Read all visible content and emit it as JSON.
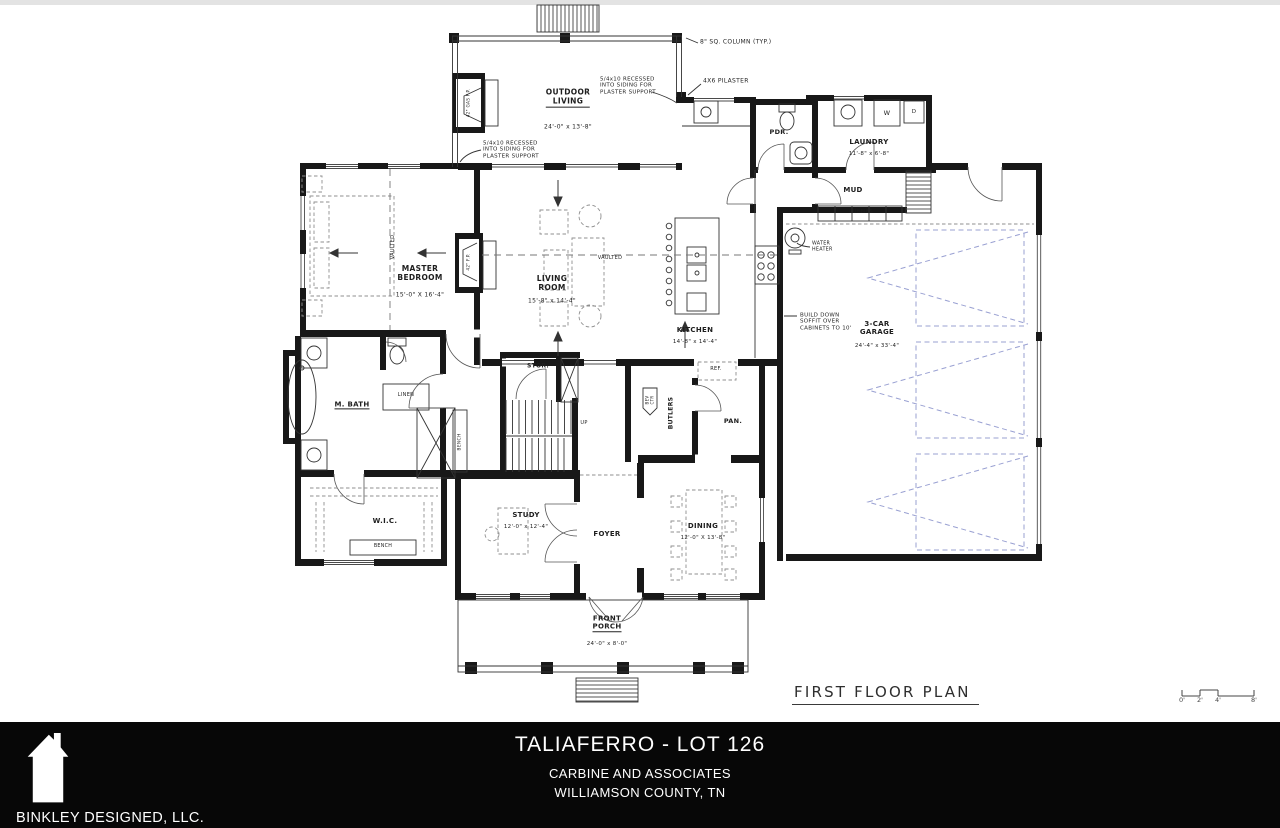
{
  "drawing": {
    "caption": "FIRST FLOOR PLAN",
    "scale_bar": {
      "tick_labels": [
        "0'",
        "2'",
        "4'",
        "8'"
      ]
    }
  },
  "plan": {
    "ink": "#181818",
    "furniture_color": "#8f8f8f",
    "garage_dash_color": "#99a0d2",
    "labels": [
      {
        "n": "room-outdoor-living",
        "t": [
          "OUTDOOR",
          "LIVING"
        ],
        "x": 568,
        "y": 98,
        "fs": 7.5,
        "b": 1,
        "ul": 1
      },
      {
        "n": "dim-outdoor-living",
        "t": [
          "24'-0\" x 13'-8\""
        ],
        "x": 568,
        "y": 127,
        "fs": 6
      },
      {
        "n": "ann-sq-column",
        "t": [
          "8\" SQ. COLUMN (TYP.)"
        ],
        "x": 700,
        "y": 42,
        "fs": 6,
        "al": "left"
      },
      {
        "n": "ann-pilaster",
        "t": [
          "4X6 PILASTER"
        ],
        "x": 703,
        "y": 81,
        "fs": 6,
        "al": "left"
      },
      {
        "n": "ann-recessed-right",
        "t": [
          "5/4x10 RECESSED",
          "INTO SIDING FOR",
          "PLASTER SUPPORT"
        ],
        "x": 600,
        "y": 86,
        "fs": 5.5,
        "al": "left"
      },
      {
        "n": "ann-recessed-left",
        "t": [
          "5/4x10 RECESSED",
          "INTO SIDING FOR",
          "PLASTER SUPPORT"
        ],
        "x": 483,
        "y": 150,
        "fs": 5.5,
        "al": "left"
      },
      {
        "n": "lbl-gas-fireplace",
        "t": [
          "42\" GAS F.P."
        ],
        "x": 469,
        "y": 103,
        "fs": 4.2,
        "r": -90
      },
      {
        "n": "room-powder",
        "t": [
          "PDR."
        ],
        "x": 779,
        "y": 133,
        "fs": 6.5,
        "b": 1
      },
      {
        "n": "room-laundry",
        "t": [
          "LAUNDRY"
        ],
        "x": 869,
        "y": 142,
        "fs": 7,
        "b": 1
      },
      {
        "n": "dim-laundry",
        "t": [
          "11'-8\" x 6'-8\""
        ],
        "x": 869,
        "y": 154,
        "fs": 5.5
      },
      {
        "n": "room-mud",
        "t": [
          "MUD"
        ],
        "x": 853,
        "y": 190,
        "fs": 7,
        "b": 1
      },
      {
        "n": "lbl-cubbies",
        "t": [
          "CUBBIES"
        ],
        "x": 861,
        "y": 213,
        "fs": 5
      },
      {
        "n": "lbl-washer",
        "t": [
          "W"
        ],
        "x": 887,
        "y": 114,
        "fs": 6.5
      },
      {
        "n": "lbl-dryer",
        "t": [
          "D"
        ],
        "x": 914,
        "y": 112,
        "fs": 5.5
      },
      {
        "n": "room-master-bedroom",
        "t": [
          "MASTER",
          "BEDROOM"
        ],
        "x": 420,
        "y": 274,
        "fs": 7.5,
        "b": 1
      },
      {
        "n": "dim-master-bedroom",
        "t": [
          "15'-0\" X 16'-4\""
        ],
        "x": 420,
        "y": 295,
        "fs": 6
      },
      {
        "n": "lbl-vaulted-master",
        "t": [
          "VAULTED"
        ],
        "x": 394,
        "y": 247,
        "fs": 5,
        "r": -90
      },
      {
        "n": "lbl-fireplace",
        "t": [
          "42\" F.P."
        ],
        "x": 469,
        "y": 262,
        "fs": 4.2,
        "r": -90
      },
      {
        "n": "room-living",
        "t": [
          "LIVING",
          "ROOM"
        ],
        "x": 552,
        "y": 284,
        "fs": 7.5,
        "b": 1
      },
      {
        "n": "dim-living",
        "t": [
          "15'-8\" x 14'-4\""
        ],
        "x": 552,
        "y": 301,
        "fs": 6
      },
      {
        "n": "lbl-vaulted-living",
        "t": [
          "VAULTED"
        ],
        "x": 610,
        "y": 259,
        "fs": 5
      },
      {
        "n": "room-kitchen",
        "t": [
          "KITCHEN"
        ],
        "x": 695,
        "y": 330,
        "fs": 7,
        "b": 1
      },
      {
        "n": "dim-kitchen",
        "t": [
          "14'-8\" x 14'-4\""
        ],
        "x": 695,
        "y": 342,
        "fs": 5.5
      },
      {
        "n": "ann-water-heater",
        "t": [
          "WATER",
          "HEATER"
        ],
        "x": 812,
        "y": 247,
        "fs": 4.8,
        "al": "left"
      },
      {
        "n": "ann-soffit",
        "t": [
          "BUILD DOWN",
          "SOFFIT OVER",
          "CABINETS TO 10'"
        ],
        "x": 800,
        "y": 322,
        "fs": 5.5,
        "al": "left"
      },
      {
        "n": "room-garage",
        "t": [
          "3-CAR",
          "GARAGE"
        ],
        "x": 877,
        "y": 328,
        "fs": 7,
        "b": 1
      },
      {
        "n": "dim-garage",
        "t": [
          "24'-4\" x 33'-4\""
        ],
        "x": 877,
        "y": 346,
        "fs": 5.5
      },
      {
        "n": "room-storage",
        "t": [
          "STOR."
        ],
        "x": 538,
        "y": 366,
        "fs": 6,
        "b": 1
      },
      {
        "n": "lbl-stairs-up",
        "t": [
          "UP"
        ],
        "x": 584,
        "y": 424,
        "fs": 5
      },
      {
        "n": "room-master-bath",
        "t": [
          "M. BATH"
        ],
        "x": 352,
        "y": 405,
        "fs": 7,
        "b": 1,
        "ul": 1
      },
      {
        "n": "lbl-linen",
        "t": [
          "LINEN"
        ],
        "x": 406,
        "y": 396,
        "fs": 5
      },
      {
        "n": "lbl-bench-vertical",
        "t": [
          "BENCH"
        ],
        "x": 460,
        "y": 442,
        "fs": 4.5,
        "r": -90
      },
      {
        "n": "room-closet",
        "t": [
          "W.I.C."
        ],
        "x": 385,
        "y": 521,
        "fs": 7,
        "b": 1
      },
      {
        "n": "lbl-bench",
        "t": [
          "BENCH"
        ],
        "x": 383,
        "y": 547,
        "fs": 4.8
      },
      {
        "n": "lbl-beverage-center",
        "t": [
          "BEV",
          "CTR"
        ],
        "x": 650,
        "y": 400,
        "fs": 4,
        "r": -90
      },
      {
        "n": "room-butlers",
        "t": [
          "BUTLERS"
        ],
        "x": 671,
        "y": 413,
        "fs": 6,
        "b": 1,
        "r": -90
      },
      {
        "n": "room-pantry",
        "t": [
          "PAN."
        ],
        "x": 733,
        "y": 422,
        "fs": 6.5,
        "b": 1
      },
      {
        "n": "lbl-refrigerator",
        "t": [
          "REF."
        ],
        "x": 716,
        "y": 370,
        "fs": 5
      },
      {
        "n": "room-study",
        "t": [
          "STUDY"
        ],
        "x": 526,
        "y": 515,
        "fs": 7,
        "b": 1
      },
      {
        "n": "dim-study",
        "t": [
          "12'-0\" x 12'-4\""
        ],
        "x": 526,
        "y": 527,
        "fs": 5.5
      },
      {
        "n": "room-foyer",
        "t": [
          "FOYER"
        ],
        "x": 607,
        "y": 534,
        "fs": 7,
        "b": 1
      },
      {
        "n": "room-dining",
        "t": [
          "DINING"
        ],
        "x": 703,
        "y": 526,
        "fs": 7,
        "b": 1
      },
      {
        "n": "dim-dining",
        "t": [
          "12'-0\" X 13'-8\""
        ],
        "x": 703,
        "y": 538,
        "fs": 5.5
      },
      {
        "n": "room-front-porch",
        "t": [
          "FRONT",
          "PORCH"
        ],
        "x": 607,
        "y": 623,
        "fs": 7,
        "b": 1,
        "ul": 1
      },
      {
        "n": "dim-front-porch",
        "t": [
          "24'-0\" x 8'-0\""
        ],
        "x": 607,
        "y": 644,
        "fs": 5.5
      }
    ]
  },
  "footer": {
    "bg": "#070707",
    "text_color": "#ffffff",
    "logo_icon": "house-silhouette",
    "company": "BINKLEY DESIGNED, LLC.",
    "project_title": "TALIAFERRO - LOT 126",
    "builder": "CARBINE AND ASSOCIATES",
    "location": "WILLIAMSON COUNTY, TN"
  }
}
